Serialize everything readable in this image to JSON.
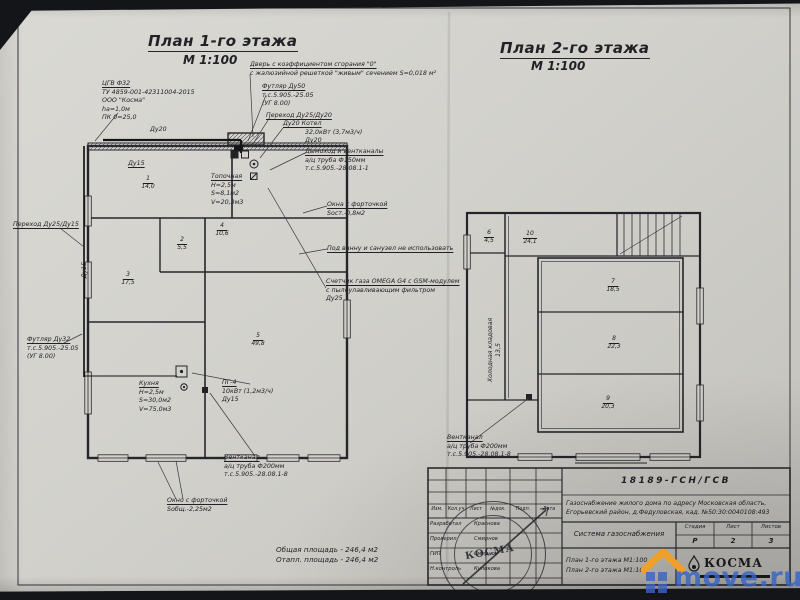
{
  "titles": {
    "floor1": "План 1-го этажа",
    "floor1_scale": "М 1:100",
    "floor2": "План 2-го этажа",
    "floor2_scale": "М 1:100"
  },
  "floor1": {
    "annotations": {
      "cgv_title": "ЦГВ Ф32",
      "cgv_body": "ТУ 4859-001-42311004-2015\nООО \"Косма\"\nhа=1,0м\nПК 0=25,0",
      "door_title": "Дверь с коэффициентом сгорания \"0\"",
      "door_body": "с жалюзийной решеткой \"живым\" сечением S=0,018 м²",
      "futlyar50_title": "Футляр Ду50",
      "futlyar50_body": "т.с.5.905.-25.05\n(УГ 8.00)",
      "perehod2520": "Переход Ду25/Ду20",
      "kotel_title": "Ду20    Котел",
      "kotel_body": "32,0кВт (3,7м3/ч)\nДу20",
      "dymohod_title": "Дымоход и вентканалы",
      "dymohod_body": "а/ц труба Ф150мм\nт.с.5.905.-28.08.1-1",
      "okna_title": "Окна с форточкой",
      "okna_body": "Sост.-0,8м2",
      "vannu": "Под ванну и санузел не использовать",
      "schetchik_title": "Счетчик газа OMEGA G4 с GSM-модулем",
      "schetchik_body": "с пылеулавливающим фильтром\nДу25",
      "perehod2515": "Переход Ду25/Ду15",
      "du15_vert": "Ду15",
      "du20_pipe": "Ду20",
      "du15_room": "Ду15",
      "futlyar32_title": "Футляр Ду32",
      "futlyar32_body": "т.с.5.905.-25.05\n(УГ 8.00)",
      "kuhnya_title": "Кухня",
      "kuhnya_body": "Н=2,5м\nS=30,0м2\nV=75,0м3",
      "pg4_title": "ПГ-4",
      "pg4_body": "10кВт (1,2м3/ч)\nДу15",
      "ventkanal_title": "Вентканал",
      "ventkanal_body": "а/ц труба Ф200мм\nт.с.5.905.-28.08.1-8",
      "okno_title": "Окно с форточкой",
      "okno_body": "Sобщ.-2,25м2",
      "topochnaya_title": "Топочная",
      "topochnaya_body": "Н=2,5м\nS=8,1м2\nV=20,3м3",
      "areas": "Общая площадь - 246,4 м2\nОтапл. площадь - 246,4 м2"
    },
    "rooms": [
      {
        "num": "1",
        "area": "14,0"
      },
      {
        "num": "2",
        "area": "5,5"
      },
      {
        "num": "3",
        "area": "17,5"
      },
      {
        "num": "4",
        "area": "10,6"
      },
      {
        "num": "5",
        "area": "49,8"
      }
    ]
  },
  "floor2": {
    "annotations": {
      "ventkanal_title": "Вентканал",
      "ventkanal_body": "а/ц труба Ф200мм\nт.с.5.905.-28.08.1-8",
      "kladovaya": "Холодная кладовая\n13,5"
    },
    "rooms": [
      {
        "num": "6",
        "area": "4,5"
      },
      {
        "num": "10",
        "area": "24,1"
      },
      {
        "num": "7",
        "area": "18,5"
      },
      {
        "num": "8",
        "area": "22,3"
      },
      {
        "num": "9",
        "area": "20,3"
      }
    ]
  },
  "titleblock": {
    "doc_number": "18189-ГСН/ГСВ",
    "project": "Газоснабжение жилого дома по адресу Московская область,\nЕгорьевский район, д.Федуловская, кад. №50:30:0040108:493",
    "system": "Система газоснабжения",
    "content": "План 1-го этажа М1:100\nПлан 2-го этажа М1:100",
    "stage_label": "Стадия",
    "sheet_label": "Лист",
    "sheets_label": "Листов",
    "stage": "Р",
    "sheet": "2",
    "sheets": "3",
    "header_cols": [
      "Изм.",
      "Кол.уч",
      "Лист",
      "№док.",
      "Подп.",
      "Дата"
    ],
    "rows": [
      {
        "role": "Разработал",
        "name": "Краснова"
      },
      {
        "role": "Проверил",
        "name": "Смирнов"
      },
      {
        "role": "ГИП",
        "name": "Смирнов"
      },
      {
        "role": "Н.контроль",
        "name": "Куликова"
      }
    ],
    "company": "КОСМА"
  },
  "watermark": {
    "text": "move.ru"
  }
}
